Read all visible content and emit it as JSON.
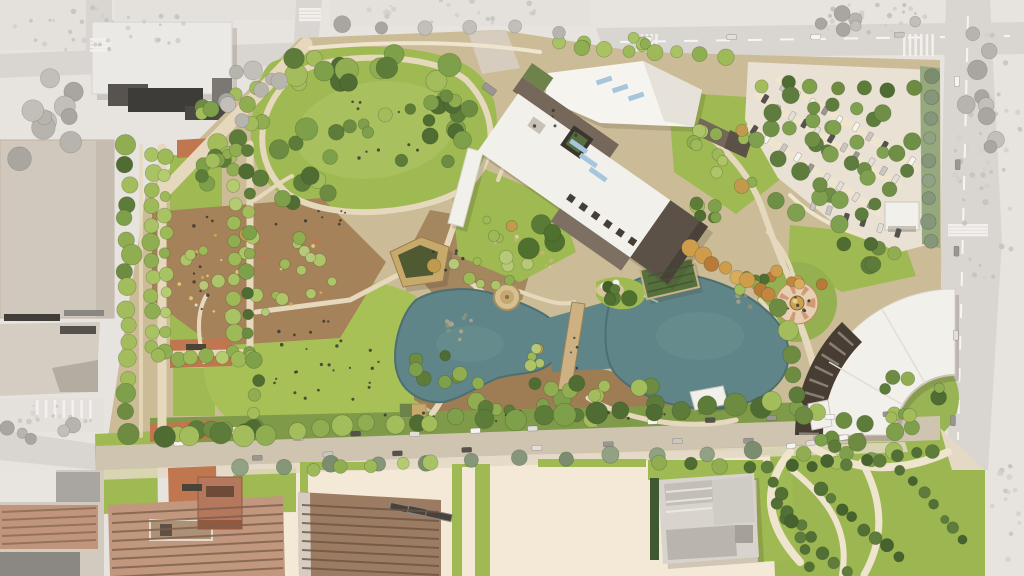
{
  "seed": 20240711,
  "scene": {
    "kind": "aerial-site-plan-rendering",
    "features": [
      "urban-context",
      "museum-building",
      "event-lawn-hill",
      "promenade-allee",
      "community-garden",
      "amphitheater-pavilion",
      "twin-ponds",
      "pedestrian-bridge",
      "round-pavilion",
      "trellis-pavilion",
      "dome-fountain-plaza",
      "crescent-building",
      "parking-lot",
      "south-street",
      "festival-plaza",
      "church-building",
      "warehouse-buildings",
      "bottom-right-garden"
    ]
  },
  "palette": {
    "bg": "#e7e3df",
    "road": "#d9d5d0",
    "roadline": "#f6f5f2",
    "ctxblock": "#e4e1dd",
    "ctxbuilding": "#ebe9e6",
    "ctxdark1": "#57544f",
    "ctxdark2": "#3e3c39",
    "ctxmid": "#7b7874",
    "beige1": "#d1c8bd",
    "beige2": "#d6cdc2",
    "parkbase": "#cbbc97",
    "lawn": "#9fba52",
    "lawnlight": "#a9c05e",
    "lawnbright": "#a8c157",
    "mulch": "#a5825a",
    "mulch2": "#9e7d55",
    "path": "#e6d8bc",
    "pathlight": "#efe4cd",
    "cream": "#f4e9d7",
    "street": "#cfc4b0",
    "sidewalk": "#e3d8c3",
    "terracotta": "#c0764f",
    "brickplaza": "#bd6f47",
    "pond": "#5f8588",
    "pondedge": "#4d6f72",
    "pondlight": "#84a4a3",
    "roofwhite": "#f2f0ea",
    "roofbright": "#f6f4ef",
    "rooftaupe": "#75685a",
    "roofdark": "#5b5146",
    "crescentband": "#473d33",
    "skylight": "#a6c6de",
    "greenroof": "#6e824c",
    "trellis": "#55703c",
    "tan": "#c8a96c",
    "pavroof": "#4f5a33",
    "gold": "#caa052",
    "brick1": "#c1977d",
    "brick2": "#9b7b62",
    "church": "#d8d4cd",
    "churchdark": "#c3bfb8",
    "parking": "#e9e1d3",
    "hedge": "#3f5a33",
    "circlegreen": "#2e7150",
    "shadow": "rgba(70,60,45,0.18)"
  },
  "tree_palettes": {
    "mixed": [
      "#4f6c33",
      "#5d7c3a",
      "#6d8c42",
      "#7fa04a",
      "#90ad52",
      "#a3bd5c"
    ],
    "light": [
      "#8fae52",
      "#9db958",
      "#a9c364",
      "#b4cb70"
    ],
    "garden": [
      "#9db958",
      "#aec468",
      "#c29a4e",
      "#8fae52",
      "#b7c979"
    ],
    "dark": [
      "#435f2c",
      "#50702f",
      "#5a7a38"
    ],
    "autumn": [
      "#c1873f",
      "#cf9c4c",
      "#b97a38",
      "#d8ab5d"
    ],
    "sgg": [
      "#86967a",
      "#91a184",
      "#7c8d6f"
    ],
    "gray": [
      "#b7b3ad",
      "#c2beb8",
      "#a9a59f"
    ],
    "pmid": [
      "#5e7c3e",
      "#6f8f46",
      "#7fa04e"
    ],
    "shrub": [
      "#46632f",
      "#527036",
      "#5e7d3d"
    ]
  },
  "car_colors": [
    "#f6f4f0",
    "#e2dfda",
    "#9a9792",
    "#55524e",
    "#c9c6c1"
  ],
  "gen": {
    "tree_clusters": [
      [
        370,
        70,
        95,
        20,
        14,
        "mixed",
        7,
        12
      ],
      [
        300,
        152,
        46,
        55,
        12,
        "mixed",
        7,
        12
      ],
      [
        448,
        126,
        20,
        46,
        8,
        "mixed",
        6,
        10
      ],
      [
        380,
        132,
        70,
        36,
        7,
        "mixed",
        5,
        8
      ],
      [
        248,
        120,
        48,
        44,
        10,
        "mixed",
        6,
        10
      ],
      [
        255,
        270,
        82,
        52,
        22,
        "garden",
        4,
        7
      ],
      [
        482,
        255,
        52,
        38,
        14,
        "garden",
        4,
        7
      ],
      [
        560,
        396,
        115,
        26,
        20,
        "mixed",
        5,
        9
      ],
      [
        432,
        372,
        28,
        20,
        7,
        "mixed",
        5,
        8
      ],
      [
        452,
        102,
        24,
        18,
        7,
        "mixed",
        6,
        9
      ],
      [
        722,
        162,
        42,
        38,
        12,
        "garden",
        5,
        8
      ],
      [
        540,
        235,
        24,
        18,
        4,
        "dark",
        8,
        12
      ],
      [
        840,
        162,
        82,
        70,
        18,
        "pmid",
        6,
        9
      ],
      [
        913,
        398,
        36,
        30,
        10,
        "mixed",
        5,
        8
      ],
      [
        795,
        280,
        30,
        13,
        6,
        "autumn",
        5,
        7
      ],
      [
        845,
        450,
        52,
        15,
        9,
        "mixed",
        6,
        9
      ],
      [
        45,
        122,
        45,
        55,
        10,
        "gray",
        7,
        12
      ],
      [
        255,
        95,
        45,
        32,
        8,
        "gray",
        6,
        10
      ],
      [
        985,
        92,
        32,
        66,
        9,
        "gray",
        6,
        10
      ],
      [
        862,
        18,
        58,
        13,
        6,
        "gray",
        5,
        8
      ],
      [
        40,
        432,
        38,
        16,
        5,
        "gray",
        5,
        8
      ],
      [
        618,
        292,
        17,
        11,
        5,
        "dark",
        5,
        8
      ],
      [
        756,
        286,
        18,
        13,
        5,
        "mixed",
        4,
        6
      ],
      [
        600,
        40,
        56,
        11,
        6,
        "light",
        5,
        8
      ],
      [
        545,
        358,
        24,
        11,
        5,
        "garden",
        4,
        6
      ],
      [
        222,
        176,
        28,
        24,
        8,
        "mixed",
        5,
        8
      ],
      [
        700,
        218,
        26,
        16,
        6,
        "mixed",
        5,
        8
      ],
      [
        870,
        250,
        30,
        18,
        7,
        "mixed",
        6,
        9
      ]
    ],
    "tree_rows": [
      [
        128,
        148,
        128,
        432,
        17,
        "mixed",
        7,
        11,
        4
      ],
      [
        152,
        154,
        152,
        348,
        12,
        "light",
        6,
        9,
        2
      ],
      [
        166,
        156,
        166,
        350,
        11,
        "light",
        5,
        8,
        2
      ],
      [
        234,
        150,
        234,
        352,
        12,
        "light",
        6,
        9,
        2
      ],
      [
        248,
        152,
        248,
        354,
        11,
        "mixed",
        5,
        8,
        2
      ],
      [
        160,
        358,
        254,
        356,
        7,
        "light",
        6,
        8,
        3
      ],
      [
        162,
        434,
        258,
        430,
        7,
        "mixed",
        7,
        10,
        3
      ],
      [
        256,
        362,
        256,
        428,
        5,
        "mixed",
        6,
        9,
        3
      ],
      [
        168,
        436,
        420,
        424,
        11,
        "mixed",
        8,
        12,
        4
      ],
      [
        432,
        420,
        760,
        406,
        13,
        "mixed",
        8,
        12,
        4
      ],
      [
        772,
        404,
        892,
        428,
        6,
        "mixed",
        7,
        10,
        4
      ],
      [
        238,
        468,
        752,
        452,
        12,
        "sgg",
        7,
        9,
        2
      ],
      [
        930,
        78,
        930,
        240,
        9,
        "sgg",
        6,
        8,
        2
      ],
      [
        760,
        84,
        916,
        90,
        7,
        "mixed",
        6,
        8,
        3
      ],
      [
        560,
        44,
        724,
        56,
        8,
        "light",
        6,
        9,
        3
      ],
      [
        312,
        468,
        432,
        464,
        5,
        "light",
        6,
        8,
        2
      ],
      [
        690,
        248,
        770,
        296,
        8,
        "autumn",
        6,
        9,
        3
      ],
      [
        782,
        310,
        800,
        418,
        6,
        "mixed",
        8,
        11,
        4
      ],
      [
        660,
        464,
        748,
        466,
        4,
        "mixed",
        6,
        8,
        2
      ],
      [
        795,
        468,
        935,
        452,
        9,
        "shrub",
        5,
        7,
        3
      ],
      [
        822,
        488,
        898,
        558,
        8,
        "shrub",
        5,
        7,
        3
      ],
      [
        902,
        470,
        962,
        542,
        7,
        "shrub",
        4,
        6,
        3
      ],
      [
        777,
        505,
        845,
        573,
        7,
        "shrub",
        5,
        7,
        3
      ],
      [
        768,
        468,
        810,
        564,
        8,
        "shrub",
        5,
        7,
        3
      ],
      [
        772,
        115,
        890,
        190,
        7,
        "pmid",
        6,
        9,
        3
      ],
      [
        758,
        142,
        860,
        212,
        6,
        "pmid",
        6,
        9,
        3
      ],
      [
        790,
        96,
        906,
        170,
        6,
        "pmid",
        6,
        9,
        3
      ],
      [
        340,
        26,
        560,
        30,
        6,
        "gray",
        6,
        9,
        3
      ]
    ],
    "car_lines": [
      {
        "x1": 180,
        "y1": 442,
        "x2": 888,
        "y2": 414,
        "n": 13,
        "w": 10,
        "h": 5
      },
      {
        "x1": 258,
        "y1": 458,
        "x2": 748,
        "y2": 440,
        "n": 8,
        "w": 10,
        "h": 5
      },
      {
        "x1": 765,
        "y1": 100,
        "x2": 896,
        "y2": 178,
        "n": 11,
        "w": 9,
        "h": 5,
        "perp": true
      },
      {
        "x1": 753,
        "y1": 130,
        "x2": 870,
        "y2": 205,
        "n": 9,
        "w": 9,
        "h": 5,
        "perp": true
      },
      {
        "x1": 783,
        "y1": 86,
        "x2": 912,
        "y2": 162,
        "n": 10,
        "w": 9,
        "h": 5,
        "perp": true
      },
      {
        "x1": 812,
        "y1": 206,
        "x2": 898,
        "y2": 232,
        "n": 6,
        "w": 9,
        "h": 5,
        "perp": true
      },
      {
        "x1": 958,
        "y1": 80,
        "x2": 954,
        "y2": 420,
        "n": 5,
        "w": 10,
        "h": 5
      },
      {
        "x1": 648,
        "y1": 40,
        "x2": 900,
        "y2": 36,
        "n": 4,
        "w": 10,
        "h": 5
      },
      {
        "x1": 792,
        "y1": 446,
        "x2": 860,
        "y2": 436,
        "n": 5,
        "w": 9,
        "h": 5
      },
      {
        "x1": 489,
        "y1": 90,
        "x2": 500,
        "y2": 98,
        "n": 1,
        "w": 14,
        "h": 7
      }
    ],
    "people": [
      {
        "x": 330,
        "y": 360,
        "rx": 70,
        "ry": 42,
        "n": 26
      },
      {
        "x": 375,
        "y": 128,
        "rx": 60,
        "ry": 34,
        "n": 12
      },
      {
        "x": 797,
        "y": 303,
        "rx": 14,
        "ry": 10,
        "n": 8
      },
      {
        "x": 200,
        "y": 255,
        "rx": 18,
        "ry": 55,
        "n": 10
      },
      {
        "x": 520,
        "y": 416,
        "rx": 180,
        "ry": 7,
        "n": 16
      },
      {
        "x": 560,
        "y": 125,
        "rx": 35,
        "ry": 18,
        "n": 7
      },
      {
        "x": 575,
        "y": 345,
        "rx": 5,
        "ry": 38,
        "n": 5
      },
      {
        "x": 445,
        "y": 262,
        "rx": 25,
        "ry": 18,
        "n": 6
      },
      {
        "x": 300,
        "y": 218,
        "rx": 60,
        "ry": 12,
        "n": 8
      }
    ],
    "dots": [
      {
        "x": 255,
        "y": 272,
        "rx": 80,
        "ry": 50,
        "n": 26,
        "r": 1.7,
        "c": [
          "#e9da74",
          "#f1f0e6",
          "#d8b052",
          "#c96f45"
        ]
      },
      {
        "x": 460,
        "y": 332,
        "rx": 16,
        "ry": 20,
        "n": 10,
        "r": 2.2,
        "c": [
          "#b5a98e",
          "#8f957b"
        ]
      },
      {
        "x": 744,
        "y": 300,
        "rx": 18,
        "ry": 10,
        "n": 8,
        "r": 2,
        "c": [
          "#9a8c72",
          "#b0a488"
        ]
      },
      {
        "x": 100,
        "y": 28,
        "rx": 95,
        "ry": 24,
        "n": 34,
        "r": 2.2,
        "c": [
          "#cfccc7",
          "#c3c0bb"
        ]
      },
      {
        "x": 988,
        "y": 150,
        "rx": 34,
        "ry": 140,
        "n": 46,
        "r": 2.4,
        "c": [
          "#d2cfca",
          "#c3c0bb"
        ]
      },
      {
        "x": 870,
        "y": 18,
        "rx": 70,
        "ry": 16,
        "n": 24,
        "r": 2.2,
        "c": [
          "#cfccc7",
          "#bfbcb7"
        ]
      },
      {
        "x": 52,
        "y": 418,
        "rx": 40,
        "ry": 14,
        "n": 14,
        "r": 2.2,
        "c": [
          "#d6d3ce",
          "#c7c4bf"
        ]
      },
      {
        "x": 450,
        "y": 12,
        "rx": 120,
        "ry": 12,
        "n": 20,
        "r": 2.2,
        "c": [
          "#d2cfca",
          "#c5c2bd"
        ]
      },
      {
        "x": 1008,
        "y": 520,
        "rx": 18,
        "ry": 55,
        "n": 14,
        "r": 2.4,
        "c": [
          "#d2cfca",
          "#c3c0bb"
        ]
      },
      {
        "x": 530,
        "y": 254,
        "rx": 40,
        "ry": 26,
        "n": 12,
        "r": 1.6,
        "c": [
          "#e4d6b0",
          "#c9b184"
        ]
      }
    ],
    "crosswalks": [
      {
        "x": 903,
        "y": 34,
        "w": 34,
        "h": 22,
        "dir": "v",
        "n": 6
      },
      {
        "x": 948,
        "y": 224,
        "w": 40,
        "h": 13,
        "dir": "h",
        "n": 4
      },
      {
        "x": 36,
        "y": 400,
        "w": 62,
        "h": 18,
        "dir": "v",
        "n": 7
      },
      {
        "x": 90,
        "y": 38,
        "w": 21,
        "h": 15,
        "dir": "h",
        "n": 4
      },
      {
        "x": 299,
        "y": 8,
        "w": 22,
        "h": 14,
        "dir": "h",
        "n": 4
      },
      {
        "x": 636,
        "y": 34,
        "w": 24,
        "h": 20,
        "dir": "v",
        "n": 5
      }
    ],
    "hatch": [
      {
        "x1": 112,
        "y1": 514,
        "x2": 283,
        "y2": 505,
        "n": 8,
        "dy": 9,
        "c": "#7d5f4d",
        "w": 2
      },
      {
        "x1": 302,
        "y1": 505,
        "x2": 439,
        "y2": 512,
        "n": 8,
        "dy": 9,
        "c": "#6e5443",
        "w": 2
      },
      {
        "x1": 2,
        "y1": 512,
        "x2": 96,
        "y2": 508,
        "n": 5,
        "dy": 8,
        "c": "#8a6a55",
        "w": 2
      },
      {
        "x1": 666,
        "y1": 492,
        "x2": 712,
        "y2": 488,
        "n": 3,
        "dy": 10,
        "c": "#efece6",
        "w": 2
      },
      {
        "x1": 648,
        "y1": 276,
        "x2": 694,
        "y2": 265,
        "n": 3,
        "dy": 8,
        "c": "#3e5530",
        "w": 1.5
      }
    ]
  }
}
